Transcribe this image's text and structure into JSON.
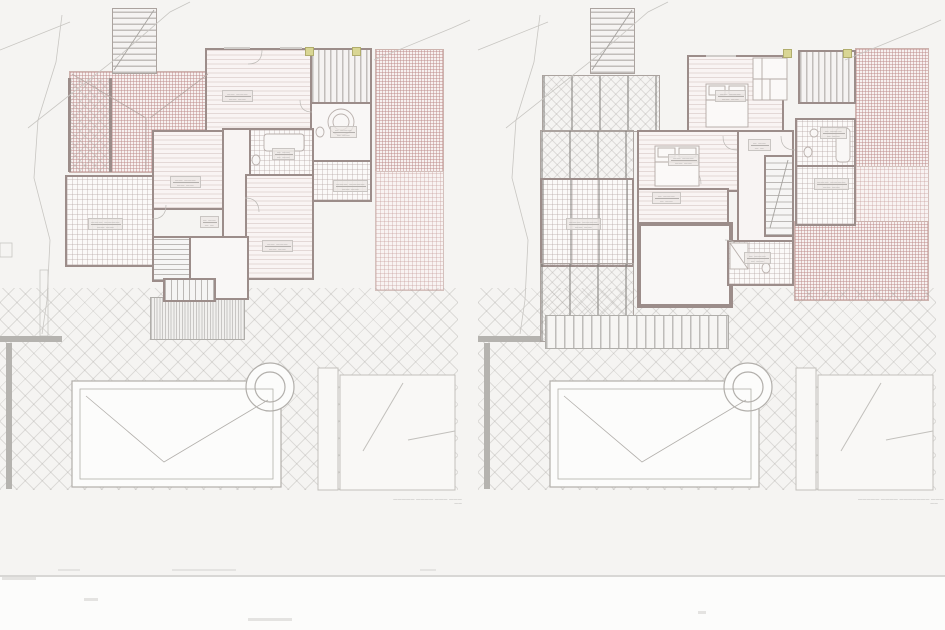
{
  "sheet": {
    "title": "two-storey house floor plans with pool (architectural sheet)",
    "colors": {
      "roof_hatch_pink": "#cf9d97",
      "wall": "#9c8d8a",
      "line": "#b9b6b2",
      "paving_line": "#c9c7c3",
      "column_marker": "#d9d694",
      "site_background": "#f5f4f2",
      "label_text": "#8b8986"
    }
  },
  "plans": {
    "left": {
      "name": "ground-floor-plan",
      "caption": {
        "l1": "————— ———— ——— ———",
        "l2": "——"
      },
      "labels": [
        {
          "name": "top-room-label",
          "l1": "—— ———",
          "l2": "—— ——"
        },
        {
          "name": "right-bath-label",
          "l1": "— ———",
          "l2": "— ——"
        },
        {
          "name": "middle-bath-label",
          "l1": "— ——",
          "l2": "— ——"
        },
        {
          "name": "left-room-label",
          "l1": "—— ———",
          "l2": "—— ——"
        },
        {
          "name": "west-terrace-label",
          "l1": "——— ————",
          "l2": "—— ——"
        },
        {
          "name": "hall-label",
          "l1": "— ——",
          "l2": "— —"
        },
        {
          "name": "bottom-room-label",
          "l1": "—— ———",
          "l2": "—— ——"
        },
        {
          "name": "east-terrace-label",
          "l1": "——— ————",
          "l2": "—— ——"
        }
      ]
    },
    "right": {
      "name": "upper-floor-plan",
      "caption": {
        "l1": "————— ———— ——————— ———",
        "l2": "——"
      },
      "labels": [
        {
          "name": "top-bedroom-label",
          "l1": "—— ———",
          "l2": "—— ——"
        },
        {
          "name": "mid-bedroom-label",
          "l1": "—— ———",
          "l2": "—— ——"
        },
        {
          "name": "small-room-label",
          "l1": "— ———",
          "l2": "— ——"
        },
        {
          "name": "hall-label",
          "l1": "— ——",
          "l2": "— —"
        },
        {
          "name": "right-bath-label",
          "l1": "— ———",
          "l2": "— ——"
        },
        {
          "name": "east-terrace-label",
          "l1": "——— ————",
          "l2": "—— ——"
        },
        {
          "name": "west-terrace-label",
          "l1": "——— ————",
          "l2": "—— ——"
        },
        {
          "name": "lower-bath-label",
          "l1": "— ———",
          "l2": "— ——"
        }
      ]
    }
  }
}
